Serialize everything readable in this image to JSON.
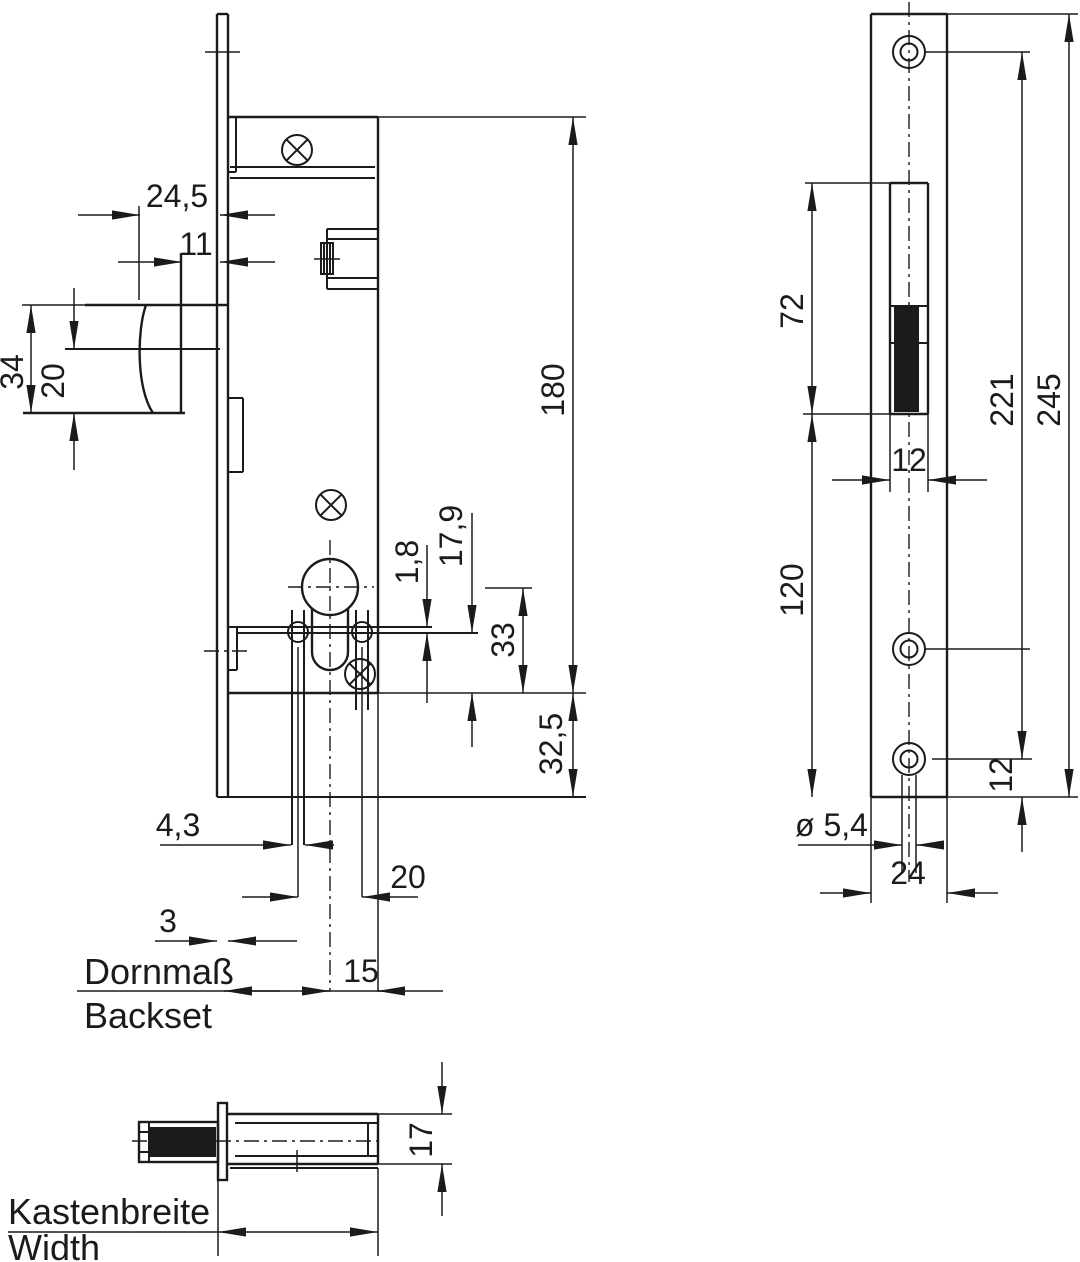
{
  "drawing": {
    "lock_body": {
      "dim_latch_head_depth": "24,5",
      "dim_latch_protrusion": "11",
      "dim_latch_total_height": "34",
      "dim_latch_height": "20",
      "dim_case_height": "180",
      "dim_nut_slot": "1,8",
      "dim_cylinder_offset": "17,9",
      "dim_cylinder_to_case_bottom": "33",
      "dim_case_to_faceplate_end": "32,5",
      "dim_fixing_hole": "4,3",
      "dim_fixing_hole_spacing": "20",
      "dim_faceplate_thickness": "3",
      "dim_centre_to_case_edge": "15",
      "label_backset_de": "Dornmaß",
      "label_backset_en": "Backset"
    },
    "strike_plate": {
      "dim_slot_length": "72",
      "dim_slot_to_bottom": "120",
      "dim_hole_spacing": "221",
      "dim_plate_length": "245",
      "dim_slot_width": "12",
      "dim_hole_to_edge": "12",
      "dim_hole_diameter": "ø 5,4",
      "dim_plate_width": "24"
    },
    "bottom_view": {
      "dim_case_thickness": "17",
      "label_width_de": "Kastenbreite",
      "label_width_en": "Width"
    }
  }
}
